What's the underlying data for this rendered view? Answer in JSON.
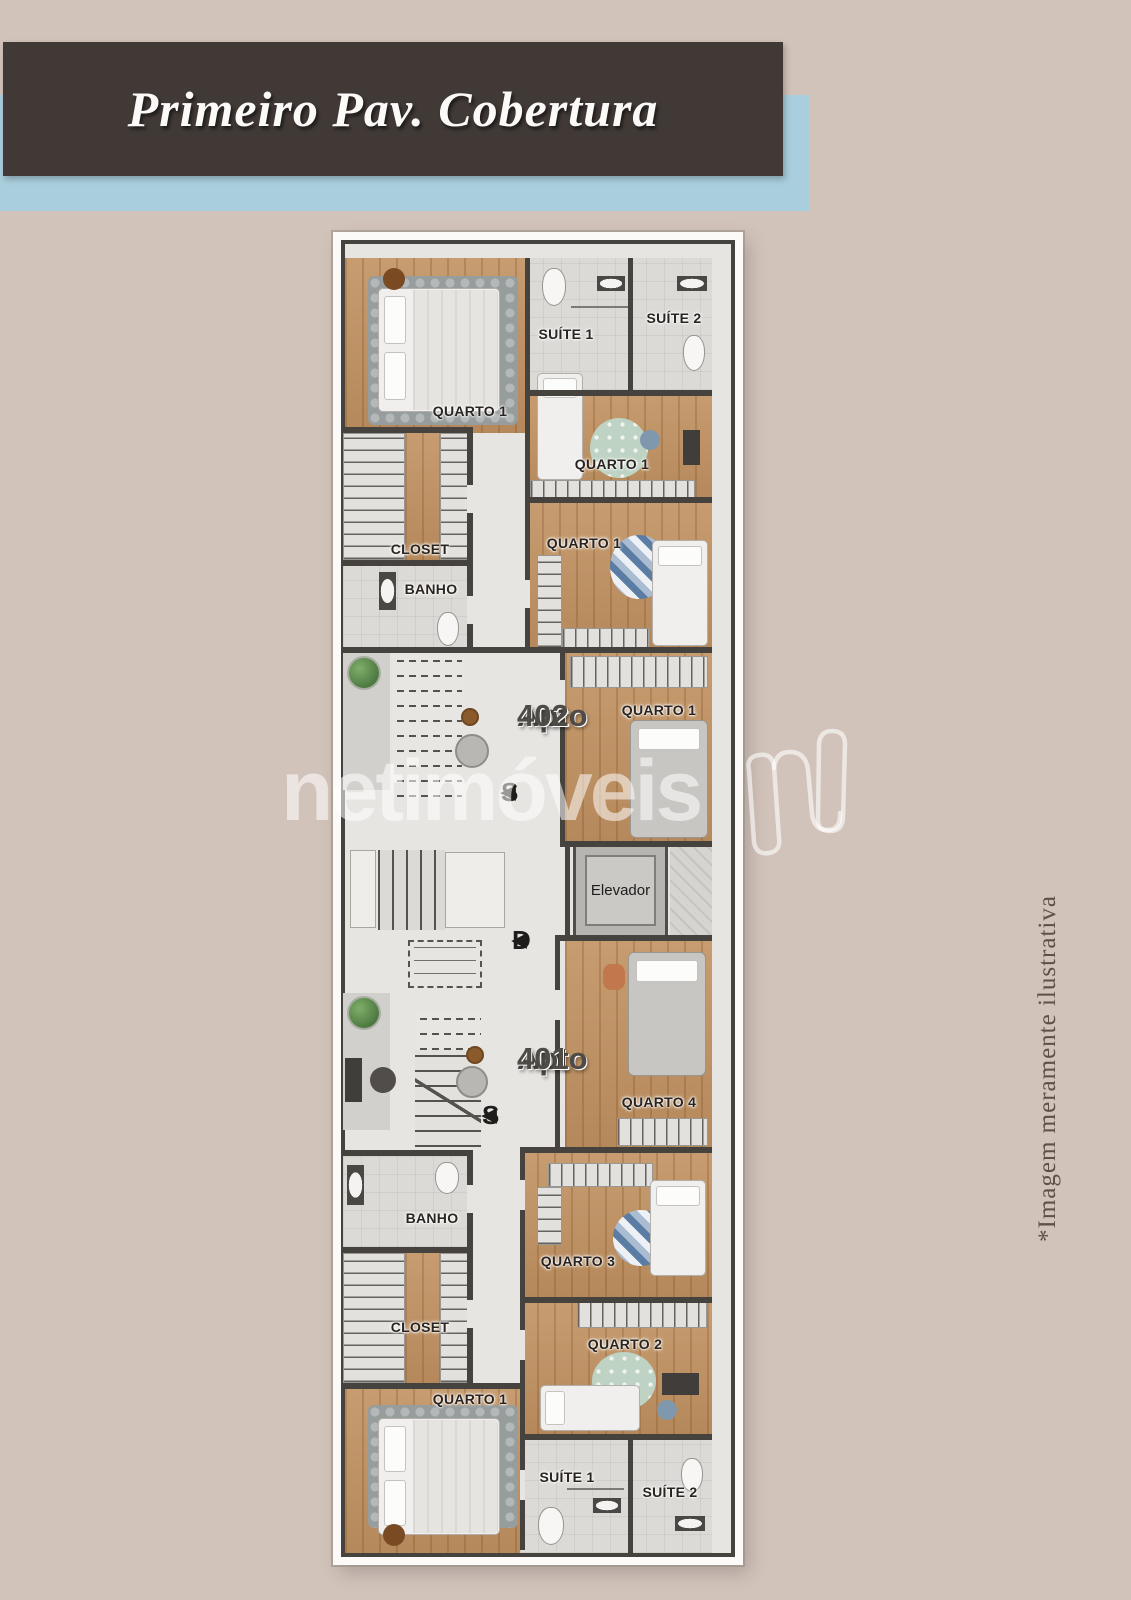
{
  "header": {
    "title": "Primeiro Pav. Cobertura"
  },
  "watermark": {
    "brand": "netimóveis"
  },
  "disclaimer": {
    "text": "*Imagem meramente ilustrativa"
  },
  "plan": {
    "apto_402": {
      "name": "Apto",
      "number": "402",
      "rooms": {
        "quarto1_main": "QUARTO 1",
        "suite1": "SUÍTE 1",
        "suite2": "SUÍTE 2",
        "quarto1_mid": "QUARTO 1",
        "quarto1_low": "QUARTO 1",
        "closet": "CLOSET",
        "banho": "BANHO",
        "quarto1_hall": "QUARTO 1"
      }
    },
    "apto_401": {
      "name": "Apto",
      "number": "401",
      "rooms": {
        "quarto4": "QUARTO 4",
        "quarto3": "QUARTO 3",
        "quarto2": "QUARTO 2",
        "quarto1_main": "QUARTO 1",
        "closet": "CLOSET",
        "banho": "BANHO",
        "suite1": "SUÍTE 1",
        "suite2": "SUÍTE 2"
      }
    },
    "common": {
      "elevator": "Elevador",
      "stair_up": "S",
      "stair_down": "D",
      "arrow": "◀"
    }
  },
  "colors": {
    "header_box": "#403936",
    "header_band": "#a9cedd",
    "background": "#d2c3ba",
    "wall": "#46433f",
    "wood_floor": "#c09160",
    "bath_floor": "#dcdad7",
    "corridor_floor": "#e7e5e2",
    "watermark_white": "rgba(255,255,255,0.55)"
  }
}
